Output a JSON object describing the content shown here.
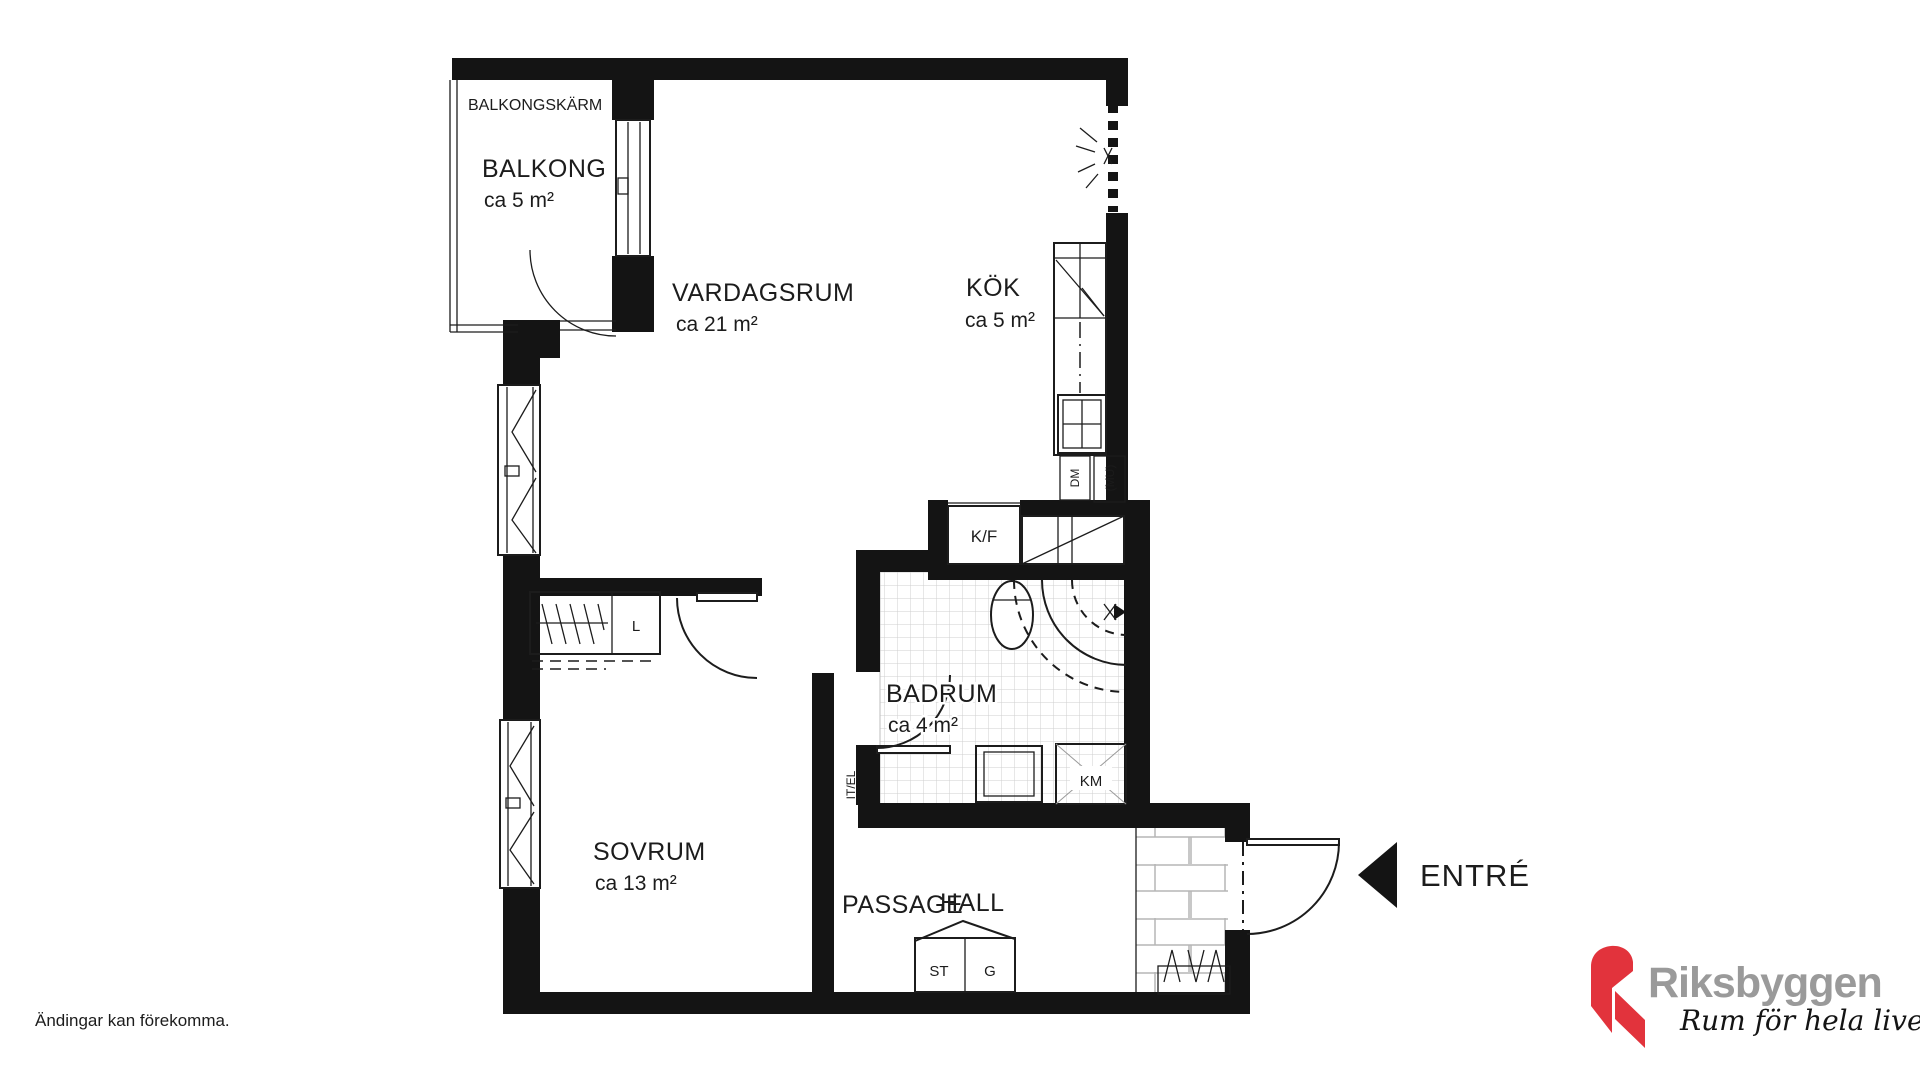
{
  "plan": {
    "balcony_screen_label": "BALKONGSKÄRM",
    "rooms": {
      "balcony": {
        "name": "BALKONG",
        "area": "ca 5 m²"
      },
      "living": {
        "name": "VARDAGSRUM",
        "area": "ca 21 m²"
      },
      "kitchen": {
        "name": "KÖK",
        "area": "ca 5 m²"
      },
      "bathroom": {
        "name": "BADRUM",
        "area": "ca 4 m²"
      },
      "bedroom": {
        "name": "SOVRUM",
        "area": "ca 13 m²"
      },
      "passage": {
        "name": "PASSAGE"
      },
      "hall": {
        "name": "HALL"
      }
    },
    "fixtures": {
      "fridge_freezer": "K/F",
      "dishwasher": "DM",
      "micro": "(MU)",
      "washing_machine": "KM",
      "it_el": "IT/EL",
      "linen_closet": "L",
      "closet_st": "ST",
      "closet_g": "G"
    },
    "entry_label": "ENTRÉ"
  },
  "footer": {
    "disclaimer": "Ändingar kan förekomma."
  },
  "brand": {
    "name": "Riksbyggen",
    "tagline": "Rum för hela livet",
    "red": "#e2333c",
    "gray": "#9a9a9a",
    "wall_black": "#141414"
  }
}
